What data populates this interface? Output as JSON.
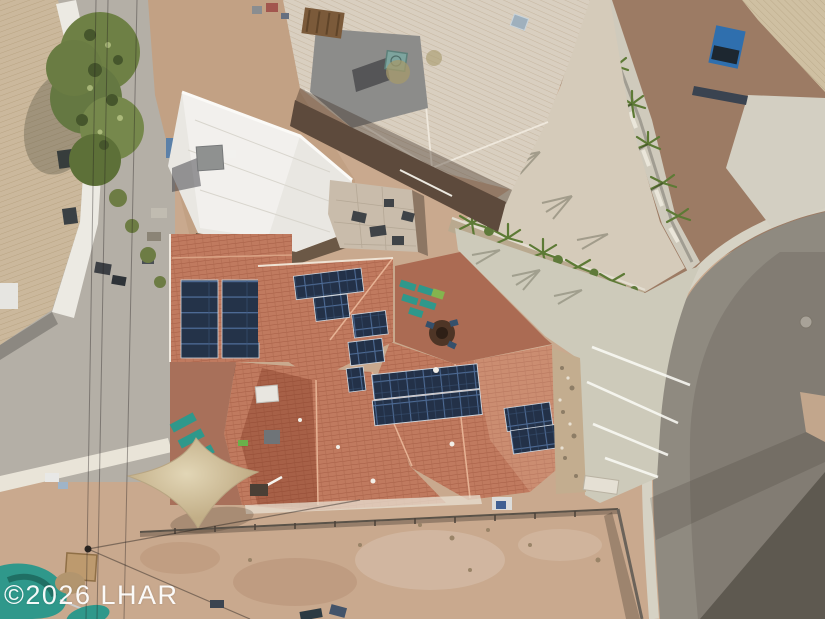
{
  "watermark": {
    "text": "©2026 LHAR"
  },
  "scene": {
    "type": "aerial-drone-photo",
    "subject": "residential property with rooftop solar panels in desert neighborhood",
    "objects": [
      {
        "name": "main-house-roof",
        "color": "#c07a5f",
        "detail": "terracotta tile hip roof"
      },
      {
        "name": "solar-array-carport",
        "panels": 10,
        "color": "#243349"
      },
      {
        "name": "solar-array-top",
        "panels": 6,
        "color": "#243349"
      },
      {
        "name": "solar-array-stair",
        "panels": 5,
        "color": "#243349"
      },
      {
        "name": "solar-array-main",
        "panels": 14,
        "color": "#243349"
      },
      {
        "name": "solar-array-right",
        "panels": 6,
        "color": "#243349"
      },
      {
        "name": "white-flat-roof-building",
        "color": "#e9e7e2"
      },
      {
        "name": "neighbor-house-roof",
        "color": "#d9cfc0"
      },
      {
        "name": "curved-street",
        "color": "#8f8a80"
      },
      {
        "name": "concrete-driveway",
        "color": "#cdcaba"
      },
      {
        "name": "shade-sail",
        "color": "#d6c7a6"
      },
      {
        "name": "teal-patio-furniture",
        "color": "#2f988b"
      },
      {
        "name": "teal-boat",
        "color": "#2f988b"
      },
      {
        "name": "large-tree",
        "color": "#6e8045"
      },
      {
        "name": "palm-trees",
        "color": "#5d7a35"
      },
      {
        "name": "desert-dirt-yard",
        "color": "#c9a98e"
      },
      {
        "name": "gravel-yard",
        "color": "#b4afa6"
      }
    ]
  },
  "palette": {
    "terracotta": "#c07a5f",
    "terracotta_dark": "#9a5540",
    "solar_panel": "#243349",
    "neighbor_roof": "#d9cfc0",
    "white_roof": "#e9e7e2",
    "concrete": "#cdcaba",
    "asphalt": "#8f8a80",
    "dirt": "#c9a98e",
    "gravel": "#b4afa6",
    "brown_gravel": "#9c7b64",
    "tree_green": "#6e8045",
    "teal": "#2f988b",
    "sail": "#d6c7a6",
    "watermark_white": "#ffffff"
  }
}
